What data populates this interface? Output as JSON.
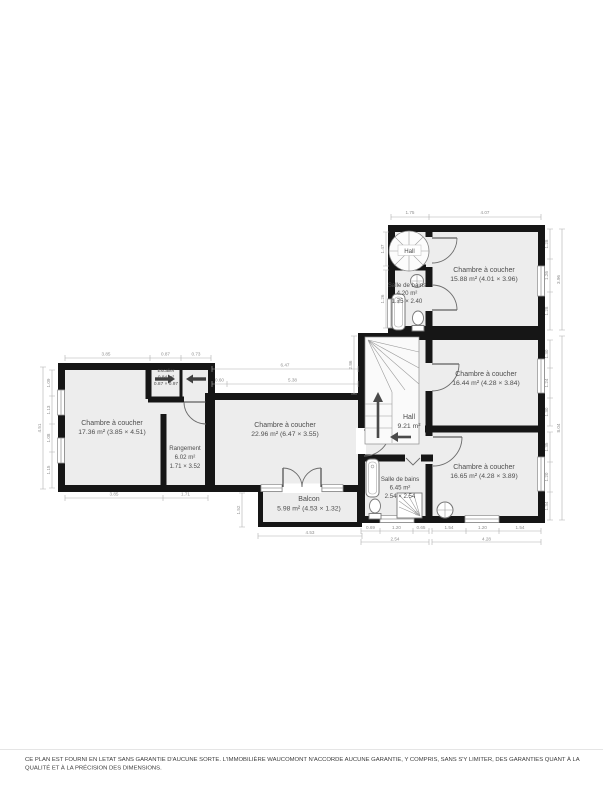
{
  "colors": {
    "wall": "#161616",
    "floor": "#ededed",
    "dimension": "#8f8f8f",
    "label": "#4d4d4d",
    "background": "#ffffff"
  },
  "rooms": {
    "chambre1": {
      "name": "Chambre à coucher",
      "detail": "15.88 m² (4.01 × 3.96)"
    },
    "chambre2": {
      "name": "Chambre à coucher",
      "detail": "16.44 m² (4.28 × 3.84)"
    },
    "chambre3": {
      "name": "Chambre à coucher",
      "detail": "16.65 m² (4.28 × 3.89)"
    },
    "chambre4": {
      "name": "Chambre à coucher",
      "detail": "17.36 m² (3.85 × 4.51)"
    },
    "chambre5": {
      "name": "Chambre à coucher",
      "detail": "22.96 m² (6.47 × 3.55)"
    },
    "hall_upper": {
      "name": "Hall"
    },
    "hall": {
      "name": "Hall",
      "area": "9.21 m²"
    },
    "bain1": {
      "name": "Salle de bains",
      "area": "4.20 m²",
      "dims": "1.75 × 2.40"
    },
    "bain2": {
      "name": "Salle de bains",
      "area": "6.45 m²",
      "dims": "2.54 × 2.54"
    },
    "rangement": {
      "name": "Rangement",
      "area": "6.02 m²",
      "dims": "1.71 × 3.52"
    },
    "escalier": {
      "name": "Escalier",
      "area": "0.84 m²",
      "dims": "0.87 × 0.97"
    },
    "balcon": {
      "name": "Balcon",
      "detail": "5.98 m² (4.53 × 1.32)"
    }
  },
  "dims": {
    "a_top_1": "1.75",
    "a_top_2": "4.07",
    "a_left_1": "1.47",
    "a_left_2": "1.26",
    "a_right_1": "1.28",
    "a_right_2": "1.26",
    "a_right_3": "1.28",
    "a_right_total": "3.96",
    "c2_right_1": "1.30",
    "c2_right_2": "1.24",
    "c2_right_3": "1.30",
    "c3_right_1": "1.35",
    "c3_right_2": "1.20",
    "c3_right_3": "1.34",
    "b_right_total": "8.04",
    "c3_bottom_1": "1.54",
    "c3_bottom_2": "1.20",
    "c3_bottom_3": "1.54",
    "c3_bottom_total": "4.28",
    "bath_bottom_1": "0.69",
    "bath_bottom_2": "1.20",
    "bath_bottom_3": "0.65",
    "bath_bottom_total": "2.54",
    "balcon_bottom": "4.53",
    "balcon_left": "1.52",
    "left_top_1": "3.85",
    "left_top_2": "0.87",
    "left_top_3": "0.73",
    "left_bottom_1": "3.85",
    "left_bottom_2": "1.71",
    "left_side_1": "1.09",
    "left_side_2": "1.13",
    "left_side_3": "1.08",
    "left_side_4": "1.15",
    "left_side_total": "4.51",
    "center_top_1": "6.47",
    "center_top_2": "5.38",
    "center_top_3": "0.60",
    "hall_left": "2.86"
  },
  "icons": {
    "spiral_staircase": "spiral-staircase-icon",
    "staircase": "staircase-icon",
    "bathtub": "bathtub-icon",
    "toilet": "toilet-icon",
    "sink": "sink-icon",
    "shower": "shower-icon",
    "sliding_door_arrow": "sliding-door-arrow-icon"
  },
  "disclaimer": {
    "line1": "CE PLAN EST FOURNI EN LETAT SANS GARANTIE D'AUCUNE SORTE. L'IMMOBILIÈRE WAUCOMONT N'ACCORDE AUCUNE GARANTIE, Y COMPRIS, SANS S'Y LIMITER, DES GARANTIES QUANT À LA",
    "line2": "QUALITÉ ET À LA PRÉCISION DES DIMENSIONS."
  }
}
